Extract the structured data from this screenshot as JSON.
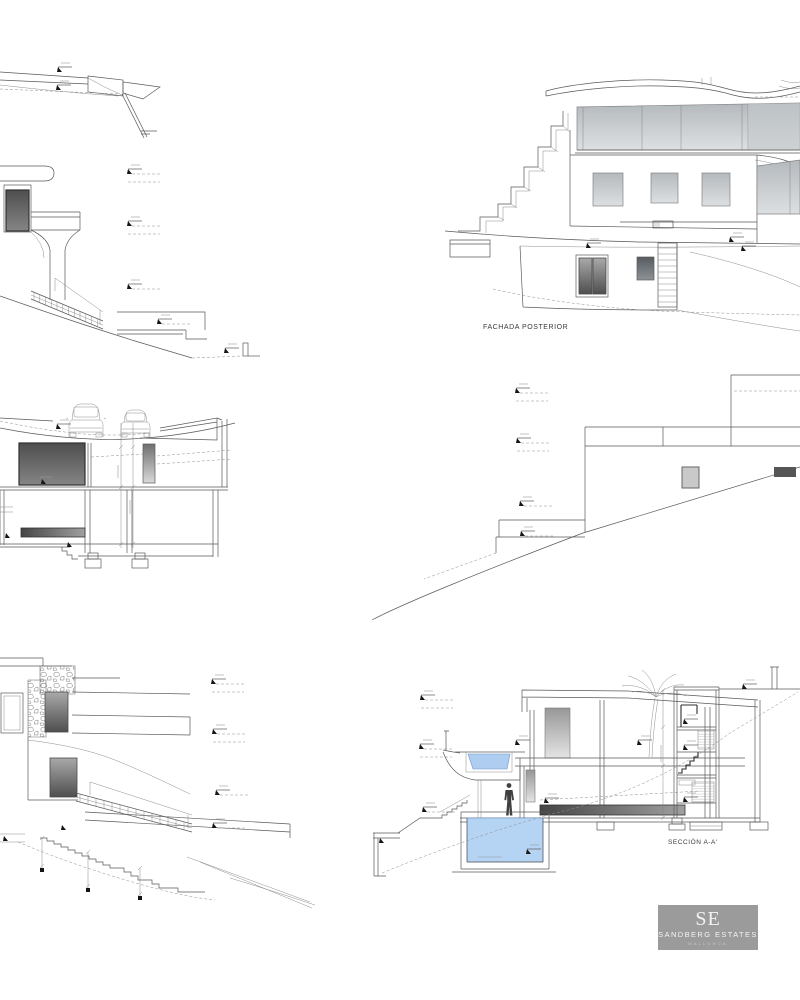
{
  "page": {
    "background_color": "#ffffff",
    "sheet_type": "architectural elevations and sections sheet"
  },
  "drawings": {
    "fachada_posterior": {
      "caption": "FACHADA POSTERIOR"
    },
    "seccion_aa": {
      "caption": "SECCIÓN A-A'"
    }
  },
  "logo": {
    "initials": "SE",
    "company": "SANDBERG ESTATES",
    "subtitle": "MALLORCA",
    "background_color": "#9b9b9b",
    "text_color": "#f3f3f3"
  },
  "colors": {
    "pool_water": "#aecdf1",
    "glass_gray": "#cdd2d6",
    "drawing_line": "#5a5a5a"
  }
}
